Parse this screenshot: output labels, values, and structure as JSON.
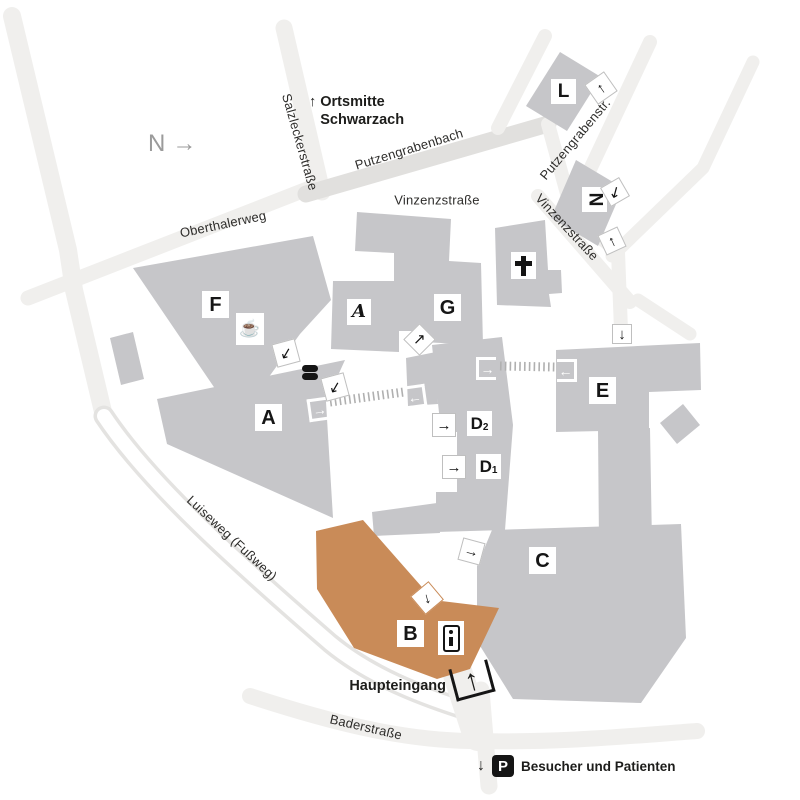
{
  "map": {
    "compass": {
      "letter": "N",
      "arrow": "→"
    },
    "direction_sign": {
      "arrow": "↑",
      "line1": "Ortsmitte",
      "line2": "Schwarzach"
    },
    "streets": {
      "salzleckerstrasse": "Salzleckerstraße",
      "putzengrabenbach": "Putzengrabenbach",
      "oberthalerweg": "Oberthalerweg",
      "vinzenzstrasse_north": "Vinzenzstraße",
      "vinzenzstrasse_east": "Vinzenzstraße",
      "putzengrabenstrasse": "Putzengrabenstr.",
      "luiseweg": "Luiseweg (Fußweg)",
      "baderstrasse": "Baderstraße"
    },
    "buildings": {
      "f": "F",
      "a": "A",
      "a_annex": "A",
      "g": "G",
      "e": "E",
      "c": "C",
      "l": "L",
      "n": "N",
      "b": "B",
      "d2": {
        "base": "D",
        "sub": "2"
      },
      "d1": {
        "base": "D",
        "sub": "1"
      }
    },
    "icons": {
      "cafeteria": "☕"
    },
    "markers": {
      "l": {
        "arrow": "↑"
      },
      "n_top": {
        "arrow": "↙"
      },
      "n_bottom": {
        "arrow": "↑"
      },
      "e_street": {
        "arrow": "↓"
      },
      "e_west": {
        "arrow": "←"
      },
      "d_top": {
        "arrow": "→"
      },
      "a_east": {
        "arrow": "→"
      },
      "d_west": {
        "arrow": "←"
      },
      "d2": {
        "arrow": "→"
      },
      "d1": {
        "arrow": "→"
      },
      "courtyard_north": {
        "arrow": "↙"
      },
      "courtyard_south": {
        "arrow": "↙"
      },
      "g": {
        "arrow": "↗"
      },
      "c": {
        "arrow": "→"
      },
      "b": {
        "arrow": "↓"
      },
      "main_entrance": {
        "arrow": "↑"
      }
    },
    "main_entrance": {
      "label": "Haupteingang"
    },
    "parking": {
      "arrow": "↓",
      "symbol": "P",
      "label": "Besucher und Patienten"
    },
    "colors": {
      "building_gray": "#c6c6c9",
      "highlight_orange": "#c98b58",
      "street_gray": "#f0efed",
      "stream_gray": "#e1e0de",
      "ink": "#1d1d1b"
    }
  }
}
